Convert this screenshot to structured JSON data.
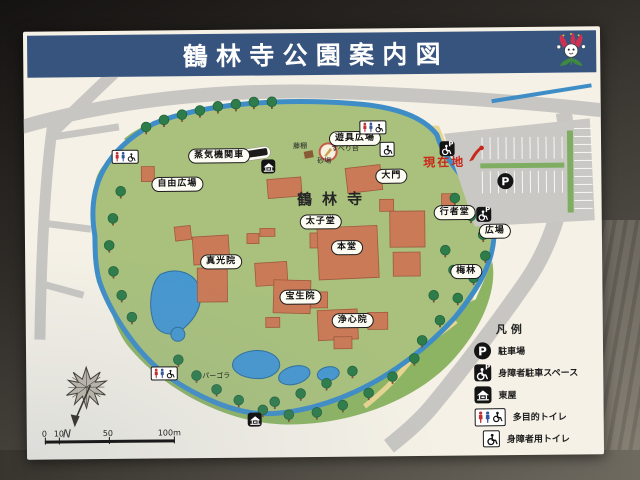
{
  "sign": {
    "title": "鶴林寺公園案内図"
  },
  "map": {
    "site_name": "鶴林寺",
    "current_location": "現在地",
    "areas": {
      "locomotive": "蒸気機関車",
      "free_plaza": "自由広場",
      "playground": "遊具広場",
      "daimon": "大門",
      "taishido": "太子堂",
      "hondo": "本堂",
      "gyojado": "行者堂",
      "plaza": "広場",
      "shinkoin": "真光院",
      "hoshoin": "宝生院",
      "joshinin": "浄心院",
      "plum_grove": "梅林",
      "wisteria": "藤棚",
      "slide": "すべり台",
      "sandbox": "砂場",
      "pergola": "パーゴラ"
    },
    "compass": {
      "north": "N"
    },
    "scalebar": {
      "ticks": [
        "0",
        "10",
        "50",
        "100m"
      ]
    }
  },
  "legend": {
    "title": "凡例",
    "items": [
      {
        "icon": "parking-icon",
        "label": "駐車場"
      },
      {
        "icon": "accessible-parking-icon",
        "label": "身障者駐車スペース"
      },
      {
        "icon": "gazebo-icon",
        "label": "東屋"
      },
      {
        "icon": "multipurpose-toilet-icon",
        "label": "多目的トイレ"
      },
      {
        "icon": "accessible-toilet-icon",
        "label": "身障者用トイレ"
      }
    ]
  },
  "icons": {
    "parking_letter": "P"
  },
  "colors": {
    "header_blue": "#37547f",
    "water_blue": "#3f8dc6",
    "park_green": "#a9c17c",
    "path_tan": "#e6d591",
    "building_salmon": "#ca7a56",
    "road_gray": "#c7c6c2",
    "current_location_red": "#c8281c"
  }
}
